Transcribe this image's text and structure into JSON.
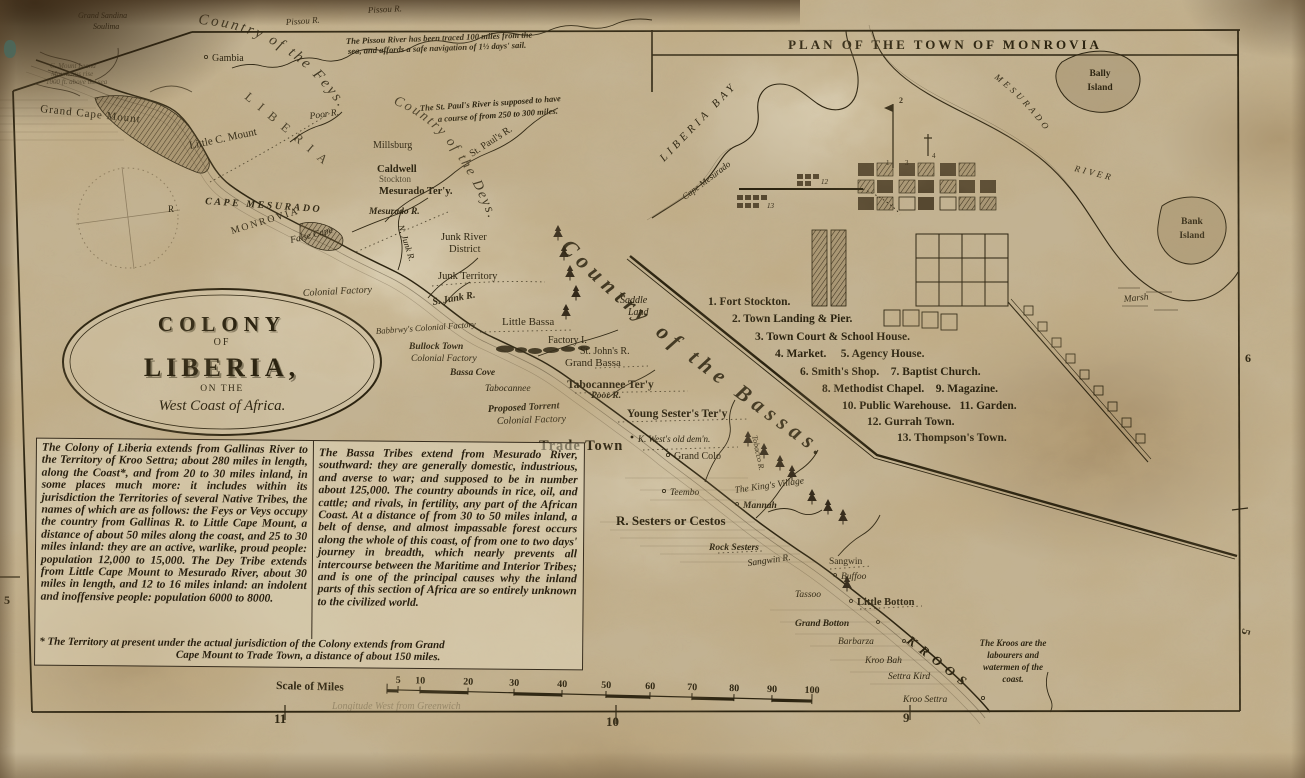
{
  "cartouche": {
    "colony": "COLONY",
    "of": "OF",
    "liberia": "LIBERIA,",
    "on_the": "ON THE",
    "west_coast": "West Coast of Africa."
  },
  "inset": {
    "title": "PLAN OF THE TOWN OF MONROVIA",
    "liberia_bay": "LIBERIA BAY",
    "cape_mesurado": "Cape Mesurado",
    "mesurado": "MESURADO",
    "river": "RIVER",
    "bally_island_1": "Bally",
    "bally_island_2": "Island",
    "bank_island_1": "Bank",
    "bank_island_2": "Island",
    "marsh": "Marsh",
    "marker_2": "2",
    "marker_1": "1",
    "marker_3": "3",
    "marker_4": "4",
    "marker_12": "12",
    "marker_13": "13",
    "legend": [
      "1. Fort Stockton.",
      "2. Town Landing & Pier.",
      "3. Town Court & School House.",
      "4. Market.     5. Agency House.",
      "6. Smith's Shop.    7. Baptist Church.",
      "8. Methodist Chapel.    9. Magazine.",
      "10. Public Warehouse.   11. Garden.",
      "12. Gurrah Town.",
      "13. Thompson's Town."
    ]
  },
  "regions": {
    "feys": "Country of the Feys.",
    "deys": "Country of the Deys.",
    "bassas": "Country of the Bassas.",
    "kroos": "KROOS",
    "liberia": "LIBERIA"
  },
  "notes": {
    "pissou_1": "The Pissou River has been traced 100 miles from the",
    "pissou_2": "sea, and affords a safe navigation of 1½ days' sail.",
    "stpauls_1": "The St. Paul's River is supposed to have",
    "stpauls_2": "a course of from 250 to 300 miles.",
    "mount_1": "C. Mount Leand",
    "mount_2": "Mountains rise",
    "mount_3": "1000 ft. above the sea",
    "kroos_1": "The Kroos are the",
    "kroos_2": "labourers and",
    "kroos_3": "watermen of the",
    "kroos_4": "coast.",
    "longitude": "Longitude West from Greenwich"
  },
  "places": {
    "grand_sandina": "Grand Sandina",
    "soulima": "Soulima",
    "pissou_r_top": "Pissou R.",
    "pissou_r": "Pissou R.",
    "gambia": "Gambia",
    "poor_r_n": "Poor R.",
    "grand_cape_mount": "Grand Cape Mount",
    "little_c_mount": "Little C. Mount",
    "millsburg": "Millsburg",
    "caldwell": "Caldwell",
    "stockton": "Stockton",
    "mesurado_tery": "Mesurado Ter'y.",
    "mesurado_r": "Mesurado R.",
    "st_pauls_r": "St. Paul's R.",
    "cape_mesurado": "CAPE MESURADO",
    "monrovia": "MONROVIA",
    "false_cape": "False Cape",
    "compass_r": "R",
    "junk_river_1": "Junk River",
    "junk_river_2": "District",
    "junk_territory": "Junk Territory",
    "n_junk_r": "N. Junk R.",
    "s_junk_r": "S. Junk R.",
    "colonial_factory_a": "Colonial Factory",
    "little_bassa": "Little Bassa",
    "saddle_1": "Saddle",
    "saddle_2": "Land",
    "babbrwys": "Babbrwy's Colonial Factory",
    "bullock_town": "Bullock Town",
    "colonial_factory_b": "Colonial Factory",
    "bassa_cove": "Bassa Cove",
    "factory_i": "Factory I.",
    "st_johns_r": "St. John's R.",
    "grand_bassa": "Grand Bassa",
    "tabocannee": "Tabocannee",
    "tabocannee_tery": "Tabocannee Ter'y",
    "poor_r_s": "Poor R.",
    "proposed": "Proposed Torrent",
    "young_sesters": "Young Sester's Ter'y",
    "colonial_factory_c": "Colonial Factory",
    "k_wests": "K. West's old dem'n.",
    "trade_town": "Trade Town",
    "grand_colo": "Grand Colo",
    "teembo": "Teembo",
    "tobacco_r": "Tobacco R.",
    "kings_village": "The King's Village",
    "mannah": "Mannah",
    "r_sesters": "R. Sesters or Cestos",
    "rock_sesters": "Rock Sesters",
    "sangwin_r": "Sangwin R.",
    "sangwin": "Sangwin",
    "buffoo": "Buffoo",
    "tassoo": "Tassoo",
    "little_botton": "Little Botton",
    "grand_botton": "Grand Botton",
    "barbarza": "Barbarza",
    "kroo_bah": "Kroo Bah",
    "settra_kird": "Settra Kird",
    "kroo_settra": "Kroo Settra"
  },
  "blocks": {
    "left": "The Colony of Liberia extends from Gallinas River to the Territory of Kroo Settra; about 280 miles in length, along the Coast*, and from 20 to 30 miles inland, in some places much more: it includes within its jurisdiction the Territories of several Native Tribes, the names of which are as follows: the Feys or Veys occupy the country from Gallinas R. to Little Cape Mount, a distance of about 50 miles along the coast, and 25 to 30 miles inland: they are an active, warlike, proud people: population 12,000 to 15,000. The Dey Tribe extends from Little Cape Mount to Mesurado River, about 30 miles in length, and 12 to 16 miles inland: an indolent and inoffensive people: population 6000 to 8000.",
    "right": "The Bassa Tribes extend from Mesurado River, southward: they are generally domestic, industrious, and averse to war; and supposed to be in number about 125,000. The country abounds in rice, oil, and cattle; and rivals, in fertility, any part of the African Coast. At a distance of from 30 to 50 miles inland, a belt of dense, and almost impassable forest occurs along the whole of this coast, of from one to two days' journey in breadth, which nearly prevents all intercourse between the Maritime and Interior Tribes; and is one of the principal causes why the inland parts of this section of Africa are so entirely unknown to the civilized world.",
    "footnote_1": "* The Territory at present under the actual jurisdiction of the Colony extends from Grand",
    "footnote_2": "Cape Mount to Trade Town, a distance of about 150 miles."
  },
  "scale": {
    "label": "Scale of Miles",
    "ticks": [
      "5",
      "10",
      "20",
      "30",
      "40",
      "50",
      "60",
      "70",
      "80",
      "90",
      "100"
    ]
  },
  "border": {
    "left_5": "5",
    "right_6": "6",
    "right_5": "5",
    "bottom_11": "11",
    "bottom_10": "10",
    "bottom_9": "9"
  },
  "colors": {
    "ink": "#2b2310",
    "paper": "#c2b292",
    "stain": "#8b6c40"
  }
}
